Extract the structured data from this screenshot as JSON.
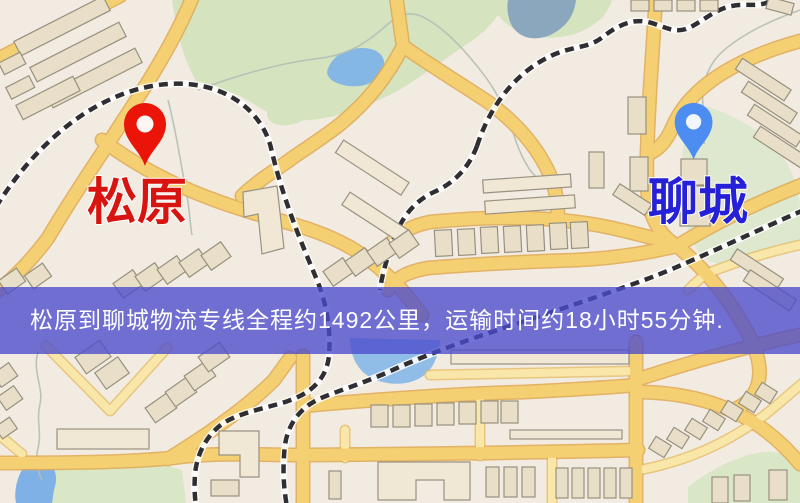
{
  "map": {
    "origin": {
      "label": "松原",
      "pin_icon": "red-map-pin",
      "pin_color": "#ea1408",
      "label_color": "#d81410"
    },
    "destination": {
      "label": "聊城",
      "pin_icon": "blue-map-pin",
      "pin_color": "#4d8df2",
      "label_color": "#2621d6"
    },
    "banner": {
      "text": "松原到聊城物流专线全程约1492公里，运输时间约18小时55分钟.",
      "distance_text": "约1492公里",
      "duration_text": "约18小时55分钟",
      "background": "#4c4acc",
      "text_color": "#ffffff"
    },
    "map_colors": {
      "land": "#f2ebe1",
      "park": "#d5e4bf",
      "water": "#85b7e4",
      "road_major": "#f4d072",
      "road_minor": "#f8e7a8",
      "railway": "#2f2f33",
      "building": "#e9dfc8"
    }
  }
}
